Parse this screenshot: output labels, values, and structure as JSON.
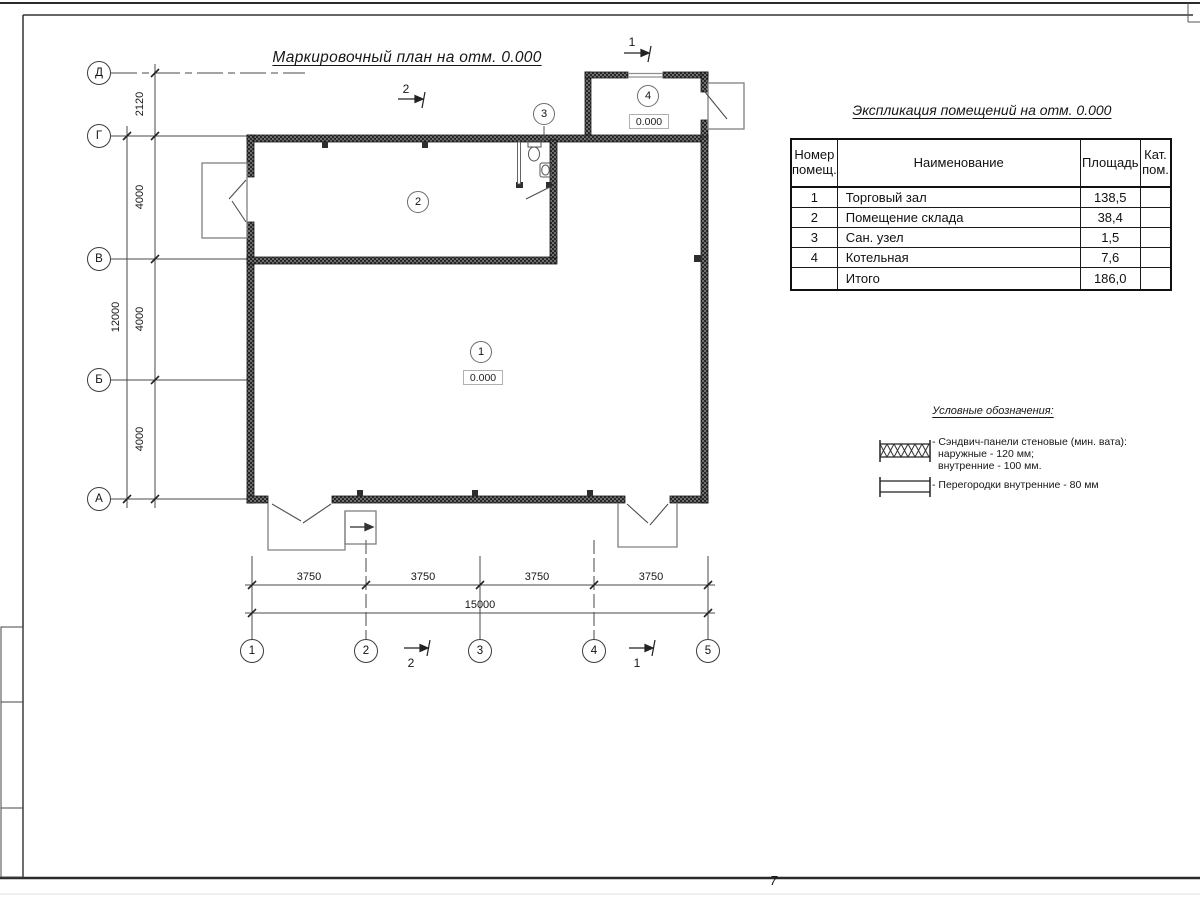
{
  "plan": {
    "title": "Маркировочный план на отм. 0.000",
    "axes_left": [
      "Д",
      "Г",
      "В",
      "Б",
      "А"
    ],
    "axes_bottom": [
      "1",
      "2",
      "3",
      "4",
      "5"
    ],
    "dims_left": [
      "2120",
      "4000",
      "4000",
      "4000"
    ],
    "dim_left_total": "12000",
    "dims_bottom": [
      "3750",
      "3750",
      "3750",
      "3750"
    ],
    "dim_bottom_total": "15000",
    "rooms": [
      {
        "num": "1",
        "elevation": "0.000"
      },
      {
        "num": "2"
      },
      {
        "num": "3"
      },
      {
        "num": "4",
        "elevation": "0.000"
      }
    ],
    "section_marks": {
      "s1": "1",
      "s2": "2"
    }
  },
  "table": {
    "title": "Экспликация помещений на отм. 0.000",
    "headers": {
      "num": "Номер помещ.",
      "name": "Наименование",
      "area": "Площадь",
      "cat": "Кат. пом."
    },
    "rows": [
      {
        "num": "1",
        "name": "Торговый зал",
        "area": "138,5",
        "cat": ""
      },
      {
        "num": "2",
        "name": "Помещение склада",
        "area": "38,4",
        "cat": ""
      },
      {
        "num": "3",
        "name": "Сан. узел",
        "area": "1,5",
        "cat": ""
      },
      {
        "num": "4",
        "name": "Котельная",
        "area": "7,6",
        "cat": ""
      },
      {
        "num": "",
        "name": "Итого",
        "area": "186,0",
        "cat": ""
      }
    ]
  },
  "legend": {
    "title": "Условные обозначения:",
    "sandwich_line1": "- Сэндвич-панели стеновые (мин. вата):",
    "sandwich_line2": "наружные - 120 мм;",
    "sandwich_line3": "внутренние - 100 мм.",
    "partitions": "- Перегородки внутренние - 80 мм"
  },
  "page": {
    "number": "7"
  }
}
